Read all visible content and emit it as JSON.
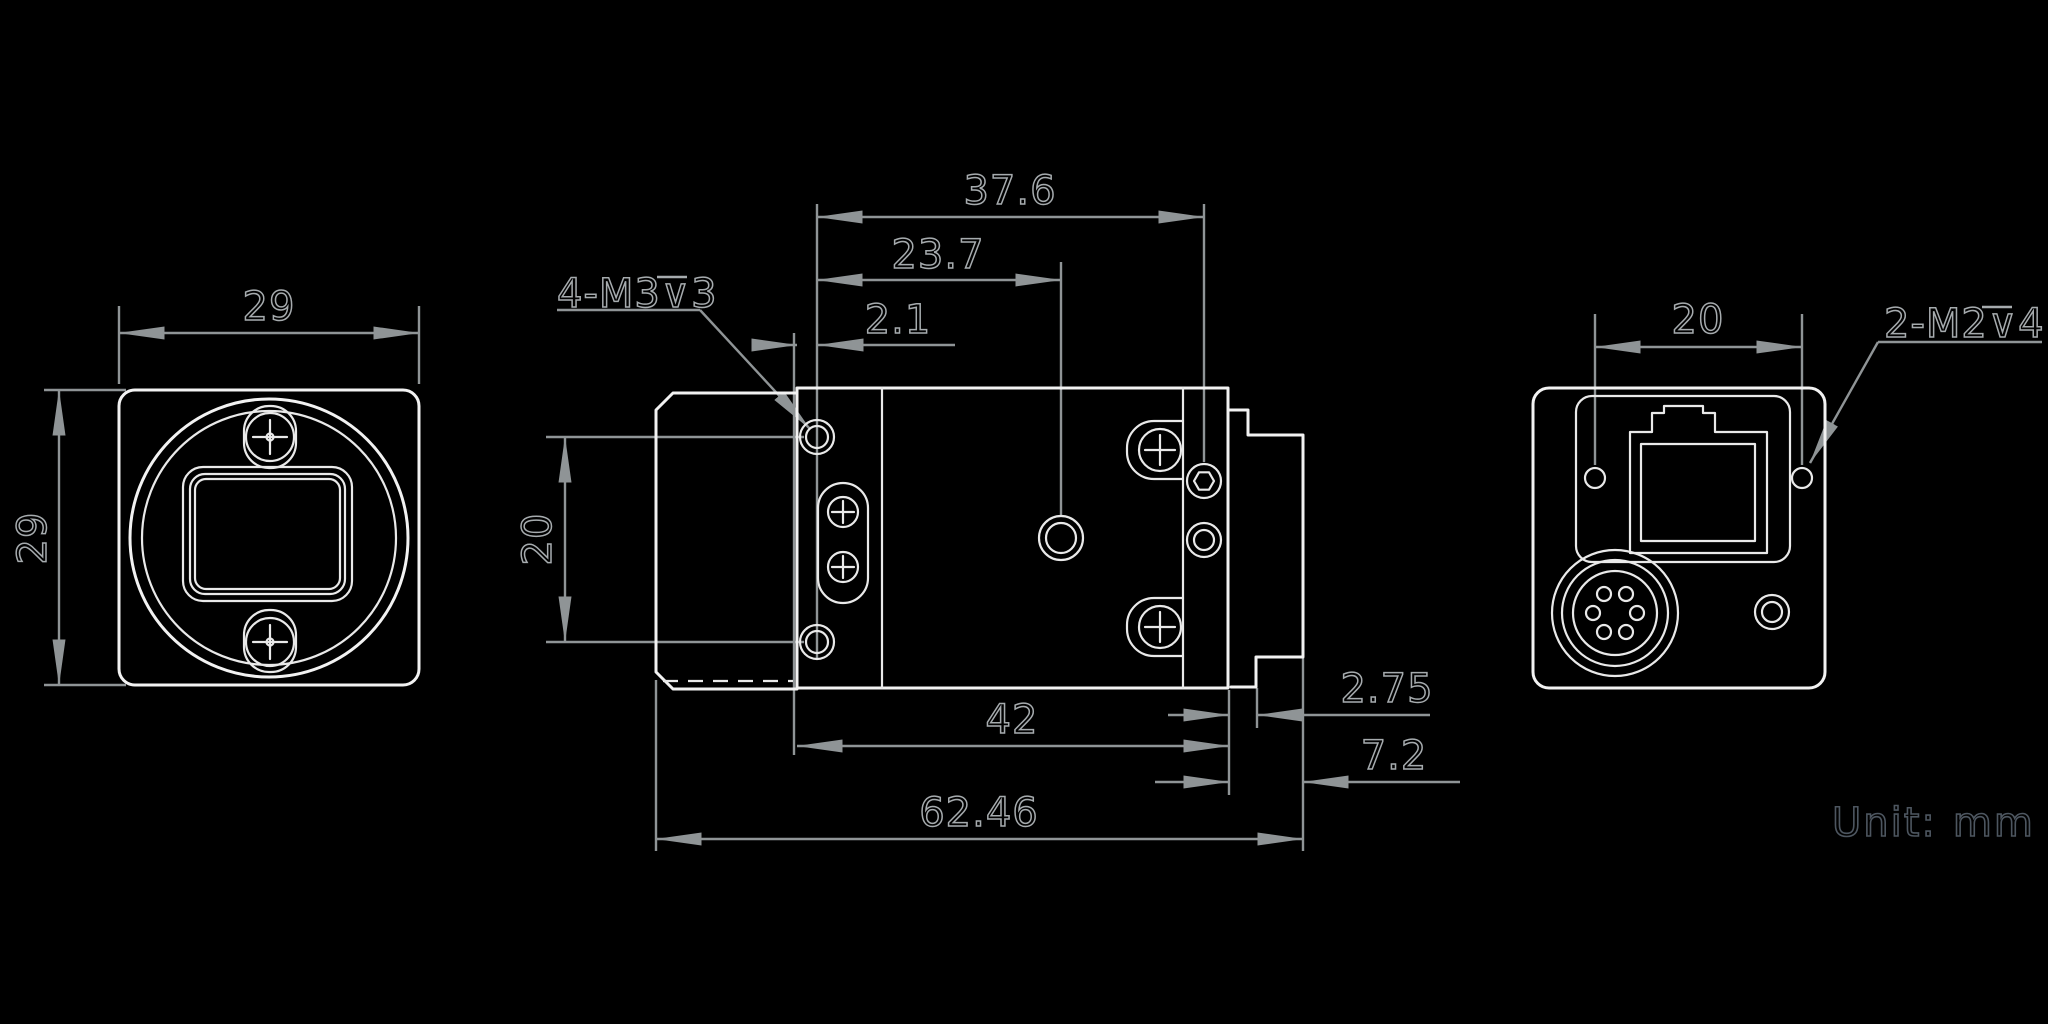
{
  "drawing": {
    "background": "#000000",
    "outline_color": "#f2f2f2",
    "dimension_color": "#8f9496",
    "unit_text_color": "#4d5660",
    "unit_note": {
      "label": "Unit:",
      "value": "mm"
    },
    "front_view": {
      "dim_width": "29",
      "dim_height": "29"
    },
    "side_view": {
      "thread_label": {
        "prefix": "4-M3",
        "depth_symbol": "∨",
        "suffix": "3"
      },
      "dim_top_total": "37.6",
      "dim_top_mid": "23.7",
      "dim_top_small": "2.1",
      "dim_left": "20",
      "dim_bottom_body": "42",
      "dim_bottom_total": "62.46",
      "dim_right_step": "2.75",
      "dim_right_block": "7.2"
    },
    "back_view": {
      "dim_top": "20",
      "thread_label": {
        "prefix": "2-M2",
        "depth_symbol": "∨",
        "suffix": "4"
      }
    }
  }
}
